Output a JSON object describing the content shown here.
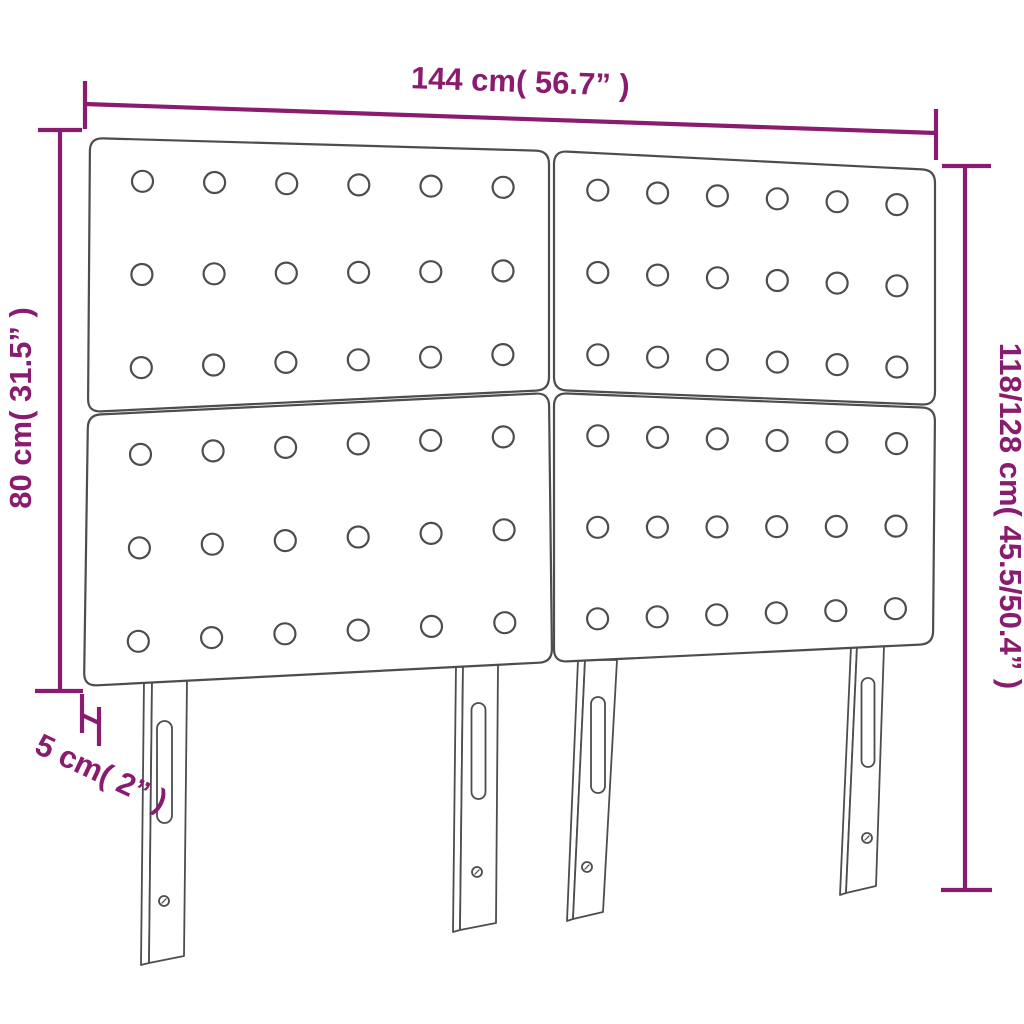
{
  "diagram": {
    "product": "upholstered-headboard-four-panels",
    "type": "dimension-diagram",
    "colors": {
      "dimension_accent": "#8a1c70",
      "outline": "#4d4d4d",
      "fill": "#ffffff"
    },
    "dimensions": {
      "width": {
        "label": "144 cm( 56.7” )"
      },
      "height_left": {
        "label": "80 cm( 31.5” )"
      },
      "height_right": {
        "label": "118/128 cm( 45.5/50.4” )"
      },
      "depth": {
        "label": "5 cm( 2” )"
      }
    },
    "panels": {
      "count": 4,
      "grid_rows": 2,
      "grid_cols": 2,
      "buttons_per_panel_rows": 3,
      "buttons_per_panel_cols": 6
    },
    "legs": {
      "count": 4
    }
  }
}
